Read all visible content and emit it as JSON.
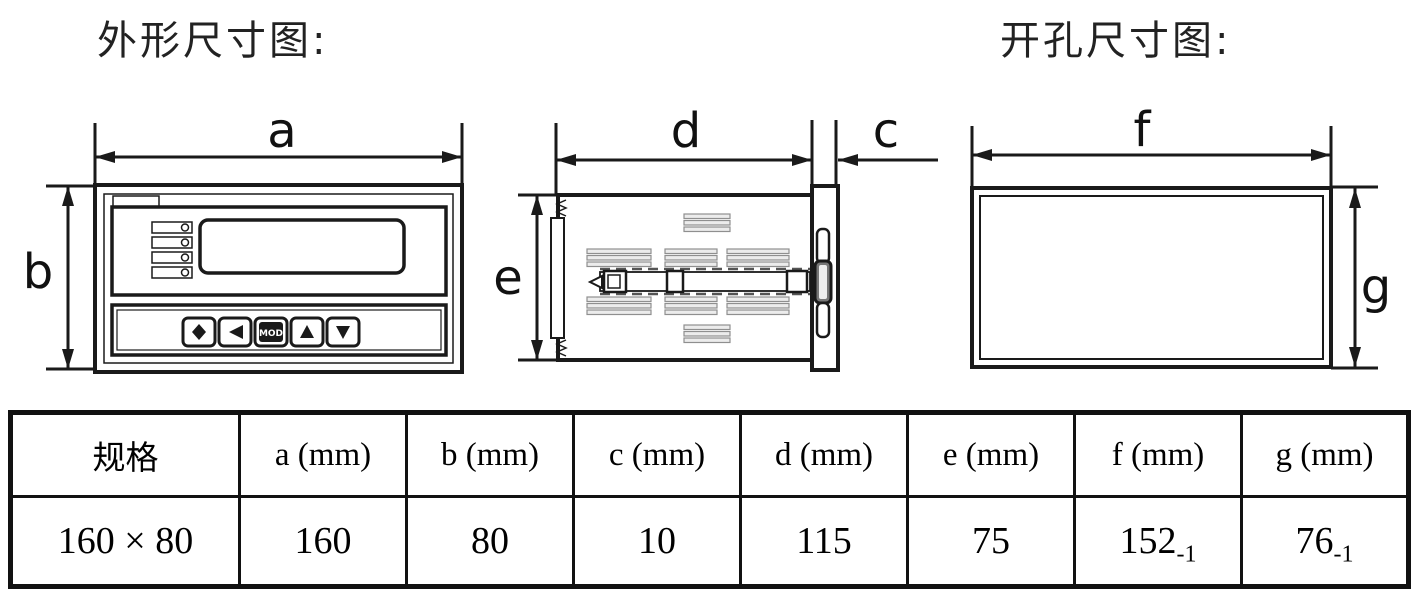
{
  "titles": {
    "outline": "外形尺寸图:",
    "cutout": "开孔尺寸图:"
  },
  "dimension_labels": {
    "a": "a",
    "b": "b",
    "c": "c",
    "d": "d",
    "e": "e",
    "f": "f",
    "g": "g"
  },
  "front_panel": {
    "mod_button_label": "MOD"
  },
  "table": {
    "headers": [
      "规格",
      "a (mm)",
      "b (mm)",
      "c (mm)",
      "d (mm)",
      "e (mm)",
      "f (mm)",
      "g (mm)"
    ],
    "row": [
      {
        "text": "160 × 80"
      },
      {
        "text": "160"
      },
      {
        "text": "80"
      },
      {
        "text": "10"
      },
      {
        "text": "115"
      },
      {
        "text": "75"
      },
      {
        "text": "152",
        "sub": "-1"
      },
      {
        "text": "76",
        "sub": "-1"
      }
    ]
  },
  "colors": {
    "line": "#1a1a1a",
    "stripe_fill": "#ececec",
    "background": "#ffffff"
  }
}
